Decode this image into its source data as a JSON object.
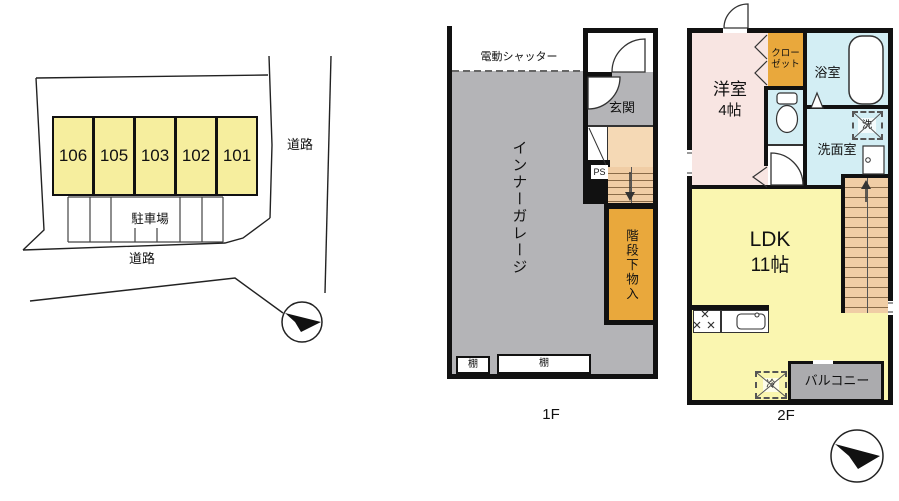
{
  "site_plan": {
    "units": [
      "106",
      "105",
      "103",
      "102",
      "101"
    ],
    "parking_label": "駐車場",
    "road_label_right": "道路",
    "road_label_bottom": "道路"
  },
  "floor_1f": {
    "name": "1F",
    "shutter": "電動シャッター",
    "garage": "インナーガレージ",
    "entrance": "玄関",
    "pipe_space": "PS",
    "under_stair_storage": "階段下物入",
    "shelf_left": "棚",
    "shelf_right": "棚"
  },
  "floor_2f": {
    "name": "2F",
    "western_room": "洋室",
    "western_room_size": "4帖",
    "closet": "クロー\nゼット",
    "bathroom": "浴室",
    "washroom": "洗面室",
    "washer": "洗",
    "ldk": "LDK",
    "ldk_size": "11帖",
    "balcony": "バルコニー",
    "refrigerator": "冷"
  },
  "colors": {
    "unit_yellow": "#F6EE9E",
    "ldk_yellow": "#FAF6B0",
    "garage_gray": "#B4B4B7",
    "room_pink": "#F8E5E2",
    "wet_area_blue": "#D3EEF4",
    "storage_orange": "#E9A83C",
    "stair_peach": "#F0CDA5",
    "hall_peach": "#F5D9B5",
    "wall_black": "#111111"
  }
}
